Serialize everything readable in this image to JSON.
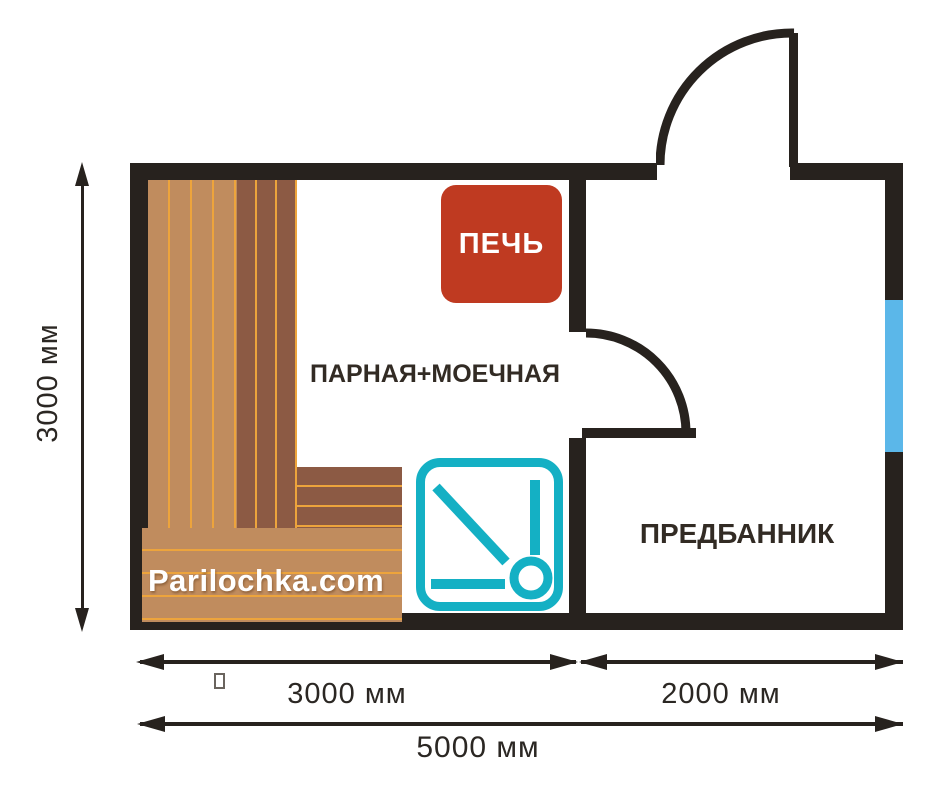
{
  "colors": {
    "wall": "#27221e",
    "wood_light": "#c08c5e",
    "wood_dark": "#8c5a44",
    "wood_line": "#eda43c",
    "stove_red": "#bf3a21",
    "shower_teal": "#14b0c4",
    "window_blue": "#5bb7e9",
    "label_text": "#322b24",
    "dim_text": "#2b2723",
    "white": "#ffffff"
  },
  "rooms": {
    "steam_wash": {
      "label": "ПАРНАЯ+МОЕЧНАЯ"
    },
    "anteroom": {
      "label": "ПРЕДБАННИК"
    }
  },
  "stove": {
    "label": "ПЕЧЬ"
  },
  "watermark": {
    "label": "Parilochka.com"
  },
  "dimensions": {
    "height_left": "3000 мм",
    "width_steam": "3000 мм",
    "width_anteroom": "2000 мм",
    "width_total": "5000 мм"
  }
}
